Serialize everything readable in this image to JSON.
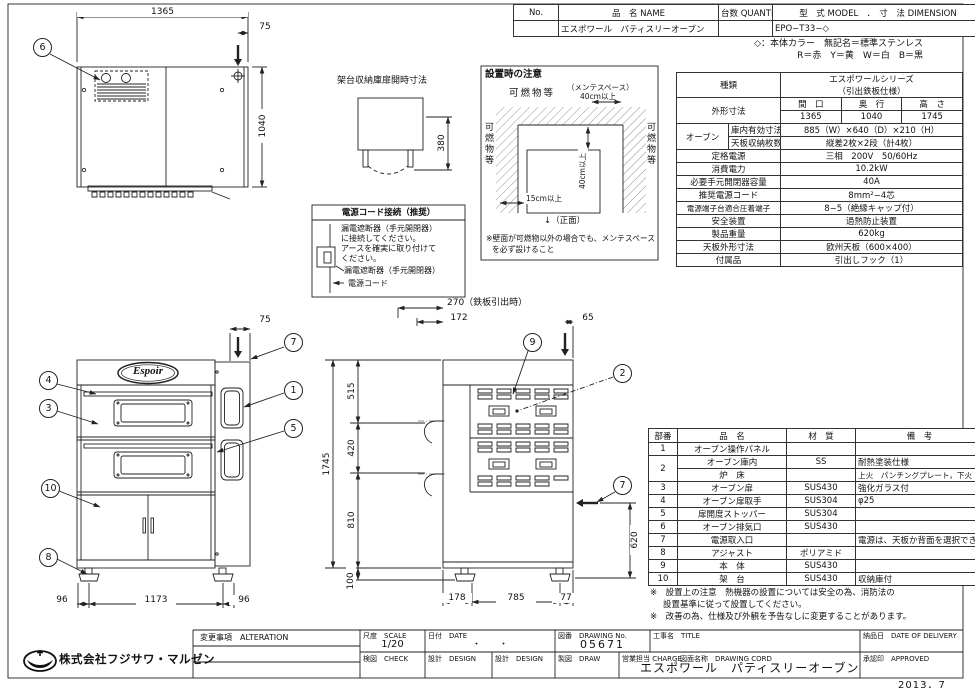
{
  "header_table": {
    "no_label": "No.",
    "name_label": "品　名 NAME",
    "qty_label": "台数 QUANTITY",
    "model_dim_label": "型　式 MODEL　．　寸　法 DIMENSION",
    "name_value": "エスポワール　パティスリーオーブン",
    "model_value": "EPO−T33−◇"
  },
  "color_note": {
    "line1": "◇：本体カラー　無記名＝標準ステンレス",
    "line2": "R＝赤　Y＝黄　W＝白　B＝黒"
  },
  "spec": {
    "kind_label": "種類",
    "kind_line1": "エスポワールシリーズ",
    "kind_line2": "（引出鉄板仕様）",
    "outer_label": "外形寸法",
    "w_label": "間　口",
    "d_label": "奥　行",
    "h_label": "高　さ",
    "w": "1365",
    "d": "1040",
    "h": "1745",
    "oven_label": "オーブン",
    "inner_label": "庫内有効寸法",
    "inner_value": "885（W）×640（D）×210（H）",
    "shelf_label": "天板収納枚数",
    "shelf_value": "縦差2枚×2段（計4枚）",
    "rows": [
      {
        "label": "定格電源",
        "value": "三相　200V　50/60Hz"
      },
      {
        "label": "消費電力",
        "value": "10.2kW"
      },
      {
        "label": "必要手元開閉器容量",
        "value": "40A"
      },
      {
        "label": "推奨電源コード",
        "value": "8mm²−4芯"
      },
      {
        "label": "電源端子台適合圧着端子",
        "value": "8−5（絶縁キャップ付）"
      },
      {
        "label": "安全装置",
        "value": "過熱防止装置"
      },
      {
        "label": "製品重量",
        "value": "620kg"
      },
      {
        "label": "天板外形寸法",
        "value": "欧州天板（600×400）"
      },
      {
        "label": "付属品",
        "value": "引出しフック（1）"
      }
    ]
  },
  "parts": {
    "h_no": "部番",
    "h_name": "品　名",
    "h_mat": "材　質",
    "h_note": "備　考",
    "rows": [
      {
        "no": "1",
        "name": "オーブン操作パネル",
        "mat": "",
        "note": ""
      },
      {
        "no": "2",
        "name": "オーブン庫内",
        "mat": "SS",
        "note": "耐熱塗装仕様"
      },
      {
        "name": "炉　床",
        "mat": "",
        "note": "上火　パンチングプレート，下火　SS"
      },
      {
        "no": "3",
        "name": "オーブン扉",
        "mat": "SUS430",
        "note": "強化ガラス付"
      },
      {
        "no": "4",
        "name": "オーブン扉取手",
        "mat": "SUS304",
        "note": "φ25"
      },
      {
        "no": "5",
        "name": "扉開度ストッパー",
        "mat": "SUS304",
        "note": ""
      },
      {
        "no": "6",
        "name": "オーブン排気口",
        "mat": "SUS430",
        "note": ""
      },
      {
        "no": "7",
        "name": "電源取入口",
        "mat": "",
        "note": "電源は、天板か背面を選択できます"
      },
      {
        "no": "8",
        "name": "アジャスト",
        "mat": "ポリアミド",
        "note": ""
      },
      {
        "no": "9",
        "name": "本　体",
        "mat": "SUS430",
        "note": ""
      },
      {
        "no": "10",
        "name": "架　台",
        "mat": "SUS430",
        "note": "収納庫付"
      }
    ]
  },
  "notes": {
    "line1": "※　設置上の注意　熱機器の設置については安全の為、消防法の",
    "line2": "設置基準に従って設置してください。",
    "line3": "※　改善の為、仕様及び外観を予告なしに変更することがあります。"
  },
  "title_block": {
    "company": "株式会社フジサワ・マルゼン",
    "alteration_label": "変更事項　ALTERATION",
    "scale_label": "尺度　SCALE",
    "scale_value": "1/20",
    "date_label": "日付　DATE",
    "date_value": "・　　・",
    "dwg_no_label": "図番　DRAWING No.",
    "dwg_no_value": "05671",
    "title_label": "工事名　TITLE",
    "delivery_label": "納品日　DATE OF DELIVERY",
    "check_label": "検図　CHECK",
    "design_label": "設計　DESIGN",
    "draw_label": "製図　DRAW",
    "charge_label": "営業担当 CHARGE",
    "dwg_name_label": "図面名称　DRAWING CORD",
    "dwg_name_value": "エスポワール　パティスリーオーブン",
    "approved_label": "承認印　APPROVED",
    "issue_date": "2013．7"
  },
  "views": {
    "top": {
      "balloon": "6",
      "dim_w": "1365",
      "dim_off": "75",
      "dim_d": "1040"
    },
    "stand_door": {
      "title": "架台収納庫扉開時寸法",
      "dim": "380"
    },
    "power_cord": {
      "title": "電源コード接続（推奨）",
      "l1": "漏電遮断器（手元開閉器）",
      "l2": "に接続してください。",
      "l3": "アースを確実に取り付けて",
      "l4": "ください。",
      "breaker_label": "漏電遮断器（手元開閉器）",
      "cord_label": "電源コード"
    },
    "installation": {
      "title": "設置時の注意",
      "top_label": "可燃物等",
      "maint_label": "（メンテスペース）",
      "maint_dim": "40cm以上",
      "left_label": "可燃物等",
      "right_label": "可燃物等",
      "v_dim": "40cm以上",
      "h_dim": "15cm以上",
      "front_label": "↓（正面）",
      "note1": "※壁面が可燃物以外の場合でも、メンテスペース",
      "note2": "を必ず設けること"
    },
    "front": {
      "logo": "Espoir",
      "dim_off": "75",
      "dim_left": "96",
      "dim_center": "1173",
      "dim_right": "96",
      "b1": "1",
      "b3": "3",
      "b4": "4",
      "b5": "5",
      "b7": "7",
      "b8": "8",
      "b10": "10"
    },
    "side": {
      "dim_pull": "270（鉄板引出時）",
      "dim_172": "172",
      "dim_65": "65",
      "dim_515": "515",
      "dim_420": "420",
      "dim_810": "810",
      "dim_100": "100",
      "dim_1745": "1745",
      "dim_620": "620",
      "dim_178": "178",
      "dim_785": "785",
      "dim_77": "77",
      "b2": "2",
      "b7": "7",
      "b9": "9"
    }
  }
}
